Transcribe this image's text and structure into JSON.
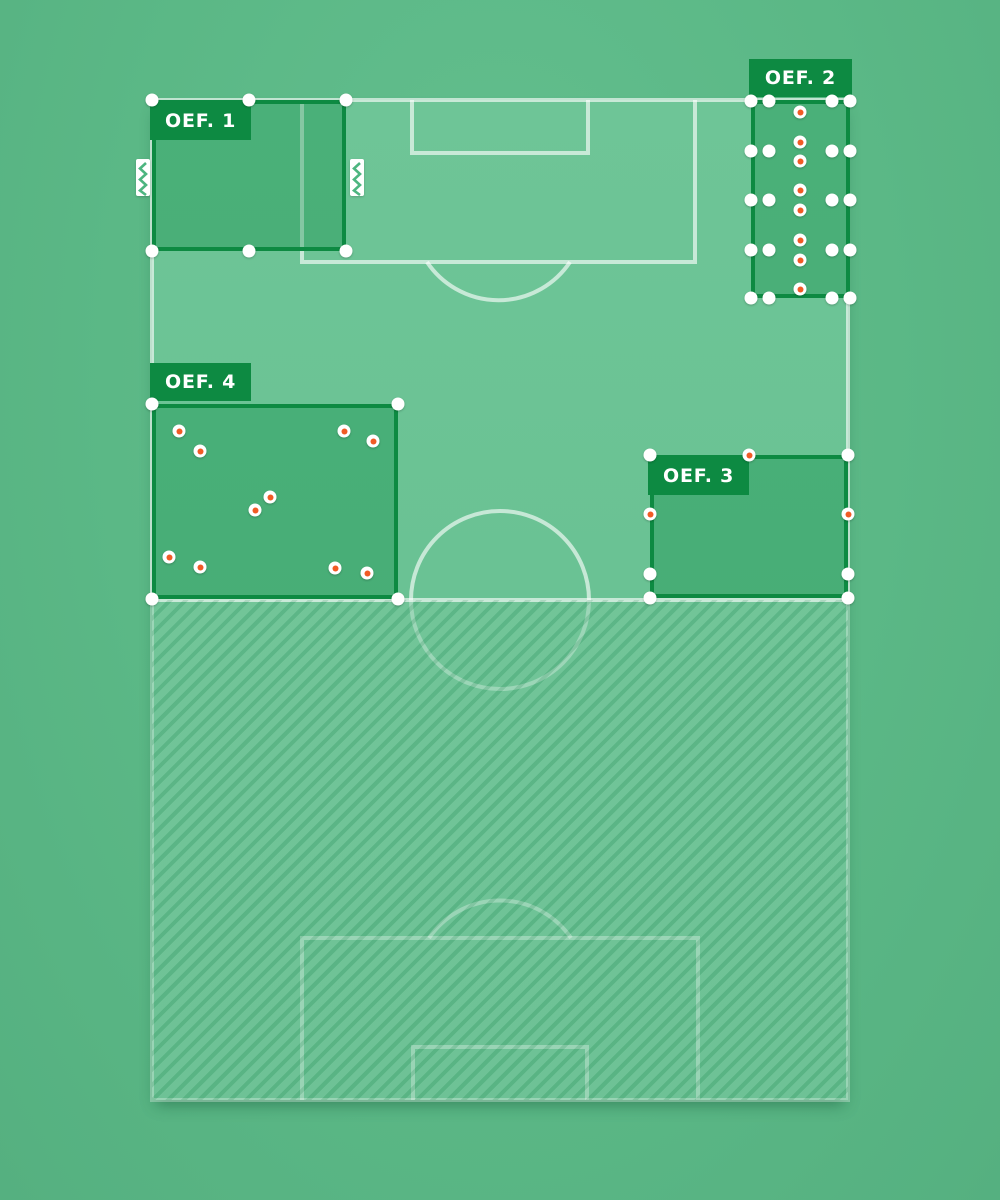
{
  "app": {
    "name": "training-pitch-planner",
    "colors": {
      "background": "#5bb886",
      "field": "#6ac294",
      "field_line": "#c9ead8",
      "zone_border": "#0d8a42",
      "zone_fill": "#48ae78",
      "label_bg": "#0d8a42",
      "label_text": "#ffffff",
      "marker_white": "#ffffff",
      "cone_orange": "#f15b25"
    }
  },
  "canvas": {
    "width": 1000,
    "height": 1200
  },
  "zones": [
    {
      "id": "oef-1",
      "label": "OEF. 1",
      "rect": {
        "x": 152,
        "y": 100,
        "w": 194,
        "h": 151
      },
      "label_placement": "inside",
      "dots": [
        {
          "x": 152,
          "y": 100,
          "kind": "handle"
        },
        {
          "x": 249,
          "y": 100,
          "kind": "handle"
        },
        {
          "x": 346,
          "y": 100,
          "kind": "handle"
        },
        {
          "x": 152,
          "y": 251,
          "kind": "handle"
        },
        {
          "x": 249,
          "y": 251,
          "kind": "handle"
        },
        {
          "x": 346,
          "y": 251,
          "kind": "handle"
        }
      ],
      "goals": [
        {
          "x": 143,
          "y": 177
        },
        {
          "x": 357,
          "y": 177
        }
      ]
    },
    {
      "id": "oef-2",
      "label": "OEF. 2",
      "rect": {
        "x": 751,
        "y": 100,
        "w": 99,
        "h": 198
      },
      "label_placement": "above",
      "dots": [
        {
          "x": 751,
          "y": 101,
          "kind": "handle"
        },
        {
          "x": 769,
          "y": 101,
          "kind": "player"
        },
        {
          "x": 832,
          "y": 101,
          "kind": "player"
        },
        {
          "x": 850,
          "y": 101,
          "kind": "handle"
        },
        {
          "x": 751,
          "y": 151,
          "kind": "player"
        },
        {
          "x": 769,
          "y": 151,
          "kind": "player"
        },
        {
          "x": 832,
          "y": 151,
          "kind": "player"
        },
        {
          "x": 850,
          "y": 151,
          "kind": "player"
        },
        {
          "x": 751,
          "y": 200,
          "kind": "player"
        },
        {
          "x": 769,
          "y": 200,
          "kind": "player"
        },
        {
          "x": 832,
          "y": 200,
          "kind": "player"
        },
        {
          "x": 850,
          "y": 200,
          "kind": "player"
        },
        {
          "x": 751,
          "y": 250,
          "kind": "player"
        },
        {
          "x": 769,
          "y": 250,
          "kind": "player"
        },
        {
          "x": 832,
          "y": 250,
          "kind": "player"
        },
        {
          "x": 850,
          "y": 250,
          "kind": "player"
        },
        {
          "x": 751,
          "y": 298,
          "kind": "handle"
        },
        {
          "x": 769,
          "y": 298,
          "kind": "player"
        },
        {
          "x": 832,
          "y": 298,
          "kind": "player"
        },
        {
          "x": 850,
          "y": 298,
          "kind": "handle"
        },
        {
          "x": 800,
          "y": 112,
          "kind": "cone"
        },
        {
          "x": 800,
          "y": 142,
          "kind": "cone"
        },
        {
          "x": 800,
          "y": 161,
          "kind": "cone"
        },
        {
          "x": 800,
          "y": 190,
          "kind": "cone"
        },
        {
          "x": 800,
          "y": 210,
          "kind": "cone"
        },
        {
          "x": 800,
          "y": 240,
          "kind": "cone"
        },
        {
          "x": 800,
          "y": 260,
          "kind": "cone"
        },
        {
          "x": 800,
          "y": 289,
          "kind": "cone"
        }
      ],
      "goals": []
    },
    {
      "id": "oef-3",
      "label": "OEF. 3",
      "rect": {
        "x": 650,
        "y": 455,
        "w": 198,
        "h": 143
      },
      "label_placement": "inside",
      "dots": [
        {
          "x": 650,
          "y": 455,
          "kind": "handle"
        },
        {
          "x": 848,
          "y": 455,
          "kind": "handle"
        },
        {
          "x": 650,
          "y": 598,
          "kind": "handle"
        },
        {
          "x": 848,
          "y": 598,
          "kind": "handle"
        },
        {
          "x": 650,
          "y": 574,
          "kind": "player"
        },
        {
          "x": 848,
          "y": 574,
          "kind": "player"
        },
        {
          "x": 749,
          "y": 455,
          "kind": "cone"
        },
        {
          "x": 650,
          "y": 514,
          "kind": "cone"
        },
        {
          "x": 848,
          "y": 514,
          "kind": "cone"
        }
      ],
      "goals": []
    },
    {
      "id": "oef-4",
      "label": "OEF. 4",
      "rect": {
        "x": 152,
        "y": 404,
        "w": 246,
        "h": 195
      },
      "label_placement": "above",
      "dots": [
        {
          "x": 152,
          "y": 404,
          "kind": "handle"
        },
        {
          "x": 398,
          "y": 404,
          "kind": "handle"
        },
        {
          "x": 152,
          "y": 599,
          "kind": "handle"
        },
        {
          "x": 398,
          "y": 599,
          "kind": "handle"
        },
        {
          "x": 179,
          "y": 431,
          "kind": "cone"
        },
        {
          "x": 200,
          "y": 451,
          "kind": "cone"
        },
        {
          "x": 344,
          "y": 431,
          "kind": "cone"
        },
        {
          "x": 373,
          "y": 441,
          "kind": "cone"
        },
        {
          "x": 270,
          "y": 497,
          "kind": "cone"
        },
        {
          "x": 255,
          "y": 510,
          "kind": "cone"
        },
        {
          "x": 169,
          "y": 557,
          "kind": "cone"
        },
        {
          "x": 200,
          "y": 567,
          "kind": "cone"
        },
        {
          "x": 335,
          "y": 568,
          "kind": "cone"
        },
        {
          "x": 367,
          "y": 573,
          "kind": "cone"
        }
      ],
      "goals": []
    }
  ]
}
